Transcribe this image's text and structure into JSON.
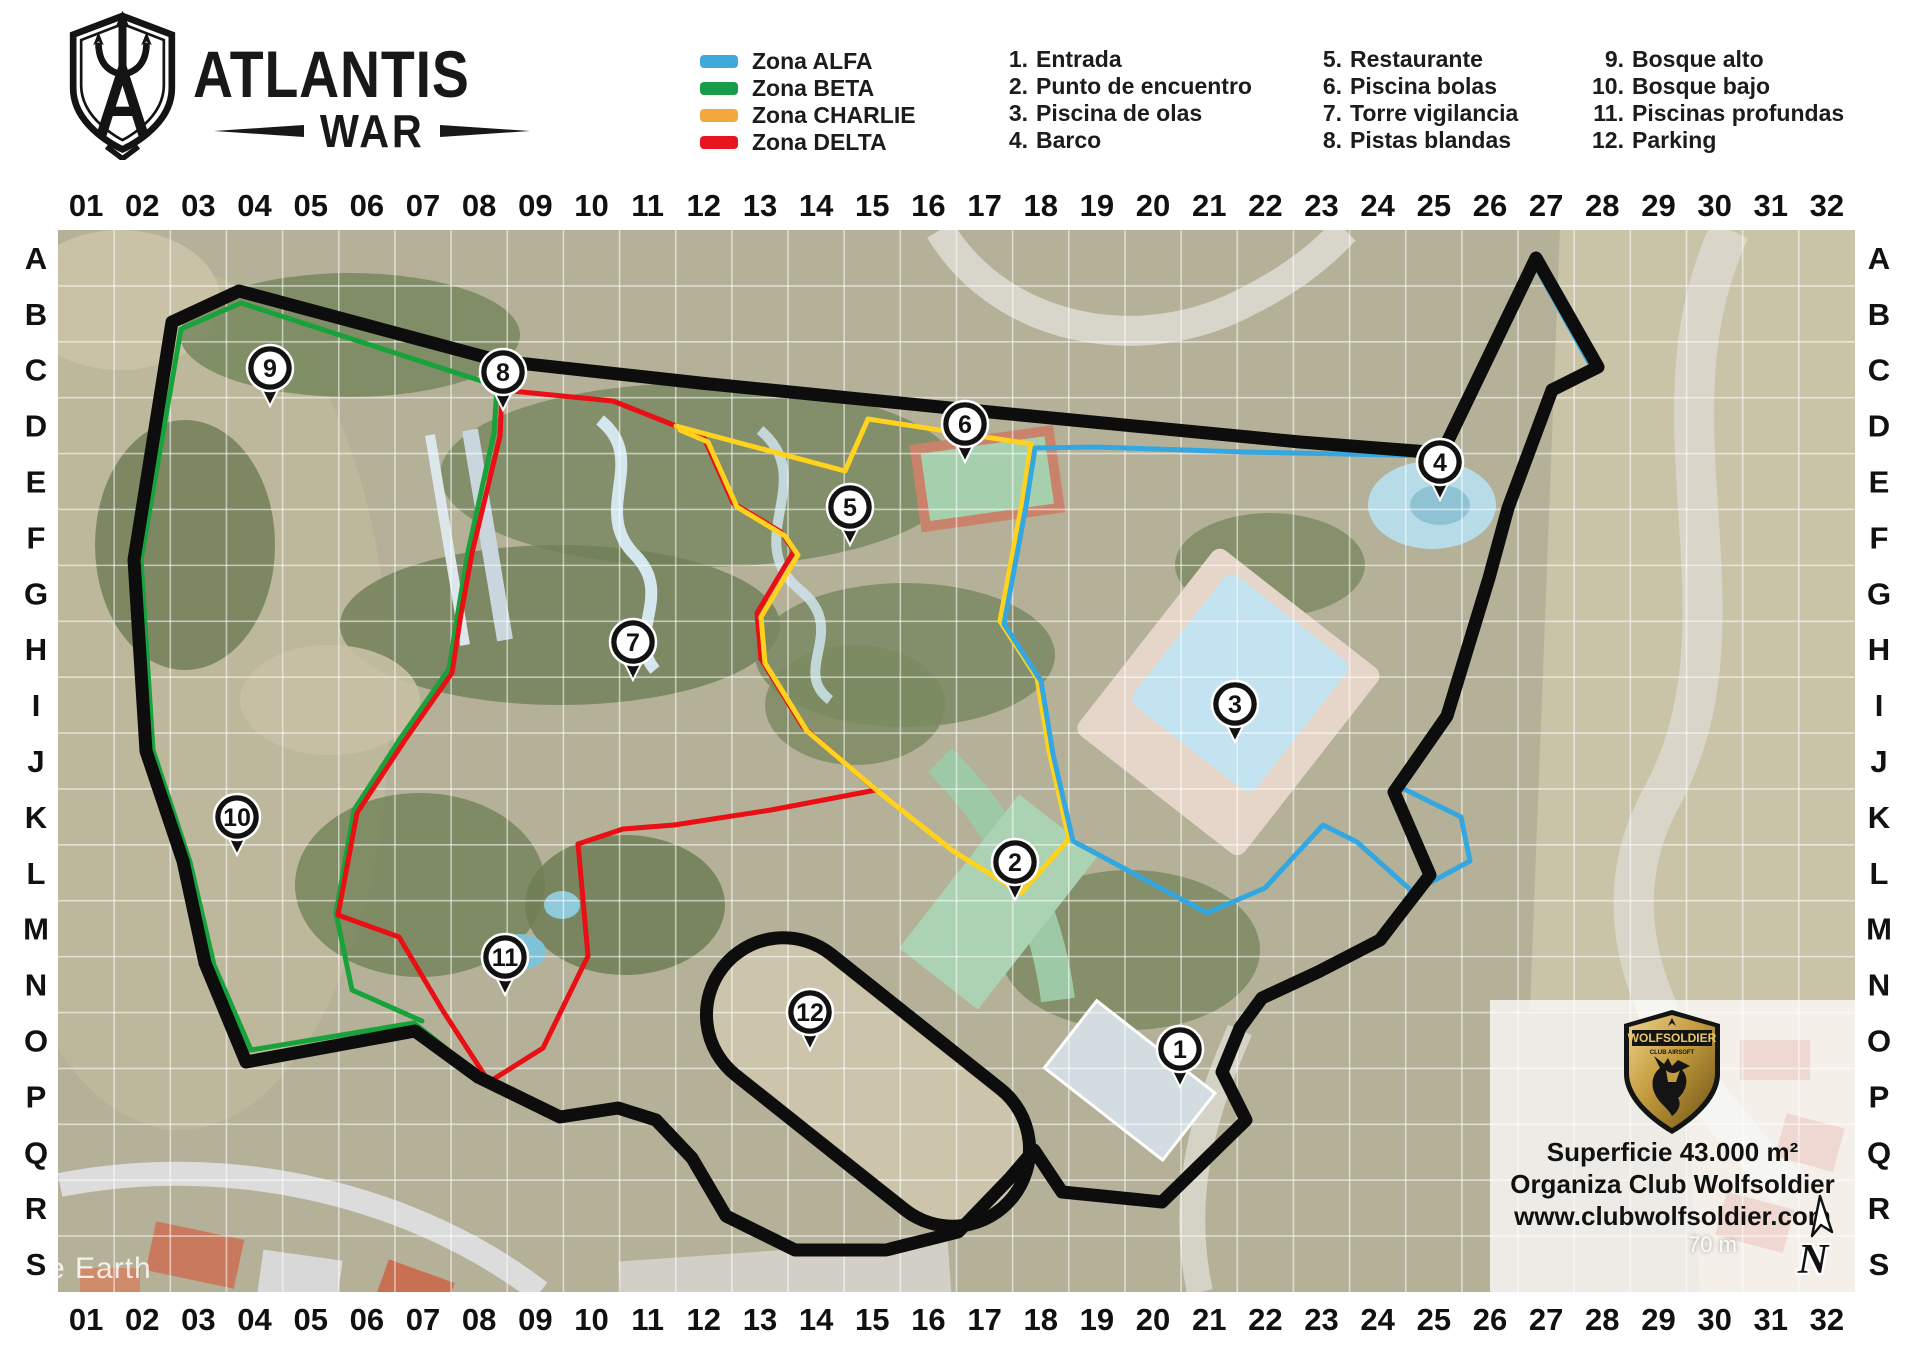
{
  "header": {
    "title": "ATLANTIS",
    "subtitle": "WAR"
  },
  "legend": {
    "zones": [
      {
        "name": "Zona ALFA",
        "color": "#3FA9DC"
      },
      {
        "name": "Zona BETA",
        "color": "#189C49"
      },
      {
        "name": "Zona CHARLIE",
        "color": "#F2A93C"
      },
      {
        "name": "Zona DELTA",
        "color": "#E8141E"
      }
    ]
  },
  "poi": [
    {
      "num": "1.",
      "label": "Entrada"
    },
    {
      "num": "2.",
      "label": "Punto de encuentro"
    },
    {
      "num": "3.",
      "label": "Piscina de olas"
    },
    {
      "num": "4.",
      "label": "Barco"
    },
    {
      "num": "5.",
      "label": "Restaurante"
    },
    {
      "num": "6.",
      "label": "Piscina bolas"
    },
    {
      "num": "7.",
      "label": "Torre vigilancia"
    },
    {
      "num": "8.",
      "label": "Pistas blandas"
    },
    {
      "num": "9.",
      "label": "Bosque alto"
    },
    {
      "num": "10.",
      "label": "Bosque bajo"
    },
    {
      "num": "11.",
      "label": "Piscinas profundas"
    },
    {
      "num": "12.",
      "label": "Parking"
    }
  ],
  "grid": {
    "cols": [
      "01",
      "02",
      "03",
      "04",
      "05",
      "06",
      "07",
      "08",
      "09",
      "10",
      "11",
      "12",
      "13",
      "14",
      "15",
      "16",
      "17",
      "18",
      "19",
      "20",
      "21",
      "22",
      "23",
      "24",
      "25",
      "26",
      "27",
      "28",
      "29",
      "30",
      "31",
      "32"
    ],
    "rows": [
      "A",
      "B",
      "C",
      "D",
      "E",
      "F",
      "G",
      "H",
      "I",
      "J",
      "K",
      "L",
      "M",
      "N",
      "O",
      "P",
      "Q",
      "R",
      "S"
    ]
  },
  "map": {
    "x": 58,
    "y": 230,
    "width": 1797,
    "height": 1062,
    "markers": [
      {
        "num": "1",
        "x": 1180,
        "y": 1085
      },
      {
        "num": "2",
        "x": 1015,
        "y": 898
      },
      {
        "num": "3",
        "x": 1235,
        "y": 740
      },
      {
        "num": "4",
        "x": 1440,
        "y": 498
      },
      {
        "num": "5",
        "x": 850,
        "y": 543
      },
      {
        "num": "6",
        "x": 965,
        "y": 460
      },
      {
        "num": "7",
        "x": 633,
        "y": 678
      },
      {
        "num": "8",
        "x": 503,
        "y": 408
      },
      {
        "num": "9",
        "x": 270,
        "y": 404
      },
      {
        "num": "10",
        "x": 237,
        "y": 853
      },
      {
        "num": "11",
        "x": 505,
        "y": 993
      },
      {
        "num": "12",
        "x": 810,
        "y": 1048
      }
    ],
    "zones": [
      {
        "name": "zona-beta-outer",
        "color": "#17A23C",
        "width": 5,
        "closed": false,
        "points": "497,386 241,303 181,329 141,560 153,750 190,862 214,965 251,1050 414,1023 468,1066"
      },
      {
        "name": "zona-beta-inner",
        "color": "#17A23C",
        "width": 5,
        "closed": false,
        "points": "497,386 494,433 468,552 458,612 449,669 402,736 354,810 336,913 352,990 422,1021"
      },
      {
        "name": "zona-delta",
        "color": "#E80F15",
        "width": 5,
        "closed": true,
        "points": "502,390 613,401 676,426 704,438 733,503 781,532 794,551 757,613 761,659 803,727 876,790 771,810 674,825 623,829 578,844 588,956 543,1048 489,1082 443,1011 399,937 338,915 357,813 405,740 452,673 461,614 472,553 500,436"
      },
      {
        "name": "zona-charlie-north",
        "color": "#FFD21E",
        "width": 5,
        "closed": false,
        "points": "676,426 845,471 868,419 1031,444 1022,503 1000,621 1037,678 1049,751 1069,839 1021,893"
      },
      {
        "name": "zona-charlie-west",
        "color": "#FFD21E",
        "width": 5,
        "closed": false,
        "points": "680,430 708,442 737,507 785,536 798,555 761,617 765,663 807,731 880,793 953,851 1021,893"
      },
      {
        "name": "zona-alfa",
        "color": "#35A7E0",
        "width": 5,
        "closed": true,
        "points": "1095,447 1245,452 1440,456 1536,267 1591,366 1549,392 1505,511 1486,580 1444,716 1398,786 1461,817 1470,861 1413,892 1357,842 1323,825 1265,888 1207,913 1073,841 1053,754 1041,681 1004,624 1026,506 1035,448"
      },
      {
        "name": "field-boundary",
        "color": "#0d0d0d",
        "width": 13,
        "closed": true,
        "points": "239,291 500,361 700,383 1000,413 1300,442 1442,453 1536,258 1598,367 1552,390 1508,508 1489,578 1447,716 1394,792 1430,875 1380,940 1318,972 1262,998 1240,1028 1222,1072 1246,1120 1162,1202 1062,1192 1034,1150 1010,1178 958,1232 886,1250 795,1250 726,1216 692,1158 656,1120 618,1108 560,1117 478,1077 415,1031 246,1062 205,963 183,861 146,751 134,560 172,322"
      }
    ],
    "parking_capsule": {
      "cx": 868,
      "cy": 1082,
      "length": 370,
      "girth": 154,
      "angle": 38.5,
      "color": "#0d0d0d",
      "width": 13
    }
  },
  "info_box": {
    "badge_title": "WOLFSOLDIER",
    "badge_subtitle": "CLUB AIRSOFT",
    "lines": [
      "Superficie 43.000 m²",
      "Organiza Club Wolfsoldier",
      "www.clubwolfsoldier.com"
    ]
  },
  "annotations": {
    "watermark": "e Earth",
    "scale_label": "70 m",
    "north_label": "N"
  }
}
